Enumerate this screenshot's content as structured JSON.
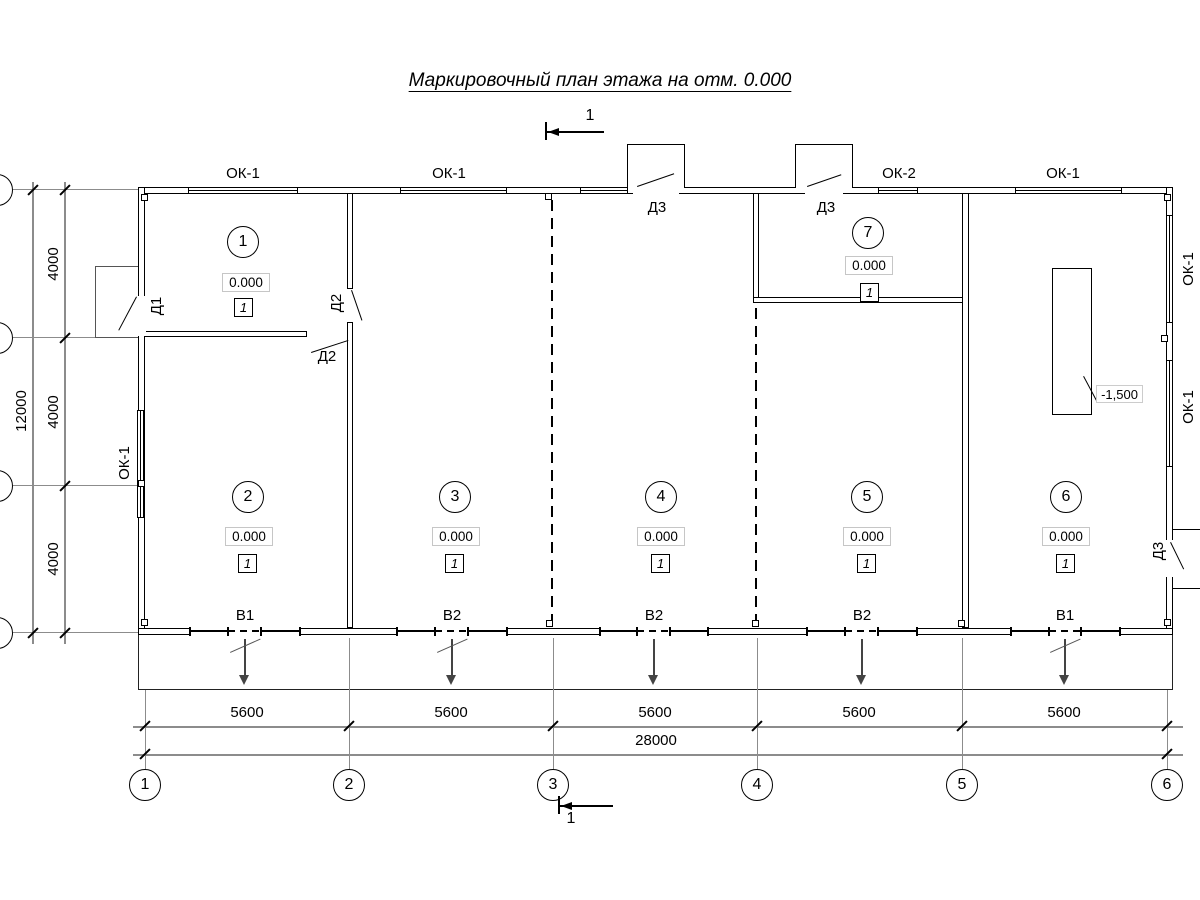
{
  "title": "Маркировочный план этажа на отм. 0.000",
  "section": {
    "top": "1",
    "bottom": "1"
  },
  "rooms": [
    {
      "number": "1",
      "elevation": "0.000",
      "mark": "1"
    },
    {
      "number": "2",
      "elevation": "0.000",
      "mark": "1"
    },
    {
      "number": "3",
      "elevation": "0.000",
      "mark": "1"
    },
    {
      "number": "4",
      "elevation": "0.000",
      "mark": "1"
    },
    {
      "number": "5",
      "elevation": "0.000",
      "mark": "1"
    },
    {
      "number": "6",
      "elevation": "0.000",
      "mark": "1"
    },
    {
      "number": "7",
      "elevation": "0.000",
      "mark": "1"
    }
  ],
  "windows": {
    "top": [
      "ОК-1",
      "ОК-1",
      "ОК-2",
      "ОК-1"
    ],
    "left": [
      "ОК-1"
    ],
    "right": [
      "ОК-1",
      "ОК-1"
    ]
  },
  "doors": {
    "d1": "Д1",
    "d2a": "Д2",
    "d2b": "Д2",
    "d3a": "Д3",
    "d3b": "Д3",
    "d3c": "Д3"
  },
  "gates": [
    "В1",
    "В2",
    "В2",
    "В2",
    "В1"
  ],
  "pit": {
    "elevation": "-1,500"
  },
  "dimensions": {
    "bottom_segments": [
      "5600",
      "5600",
      "5600",
      "5600",
      "5600"
    ],
    "bottom_total": "28000",
    "left_segments": [
      "4000",
      "4000",
      "4000"
    ],
    "left_total": "12000"
  },
  "grid": {
    "columns": [
      "1",
      "2",
      "3",
      "4",
      "5",
      "6"
    ]
  }
}
